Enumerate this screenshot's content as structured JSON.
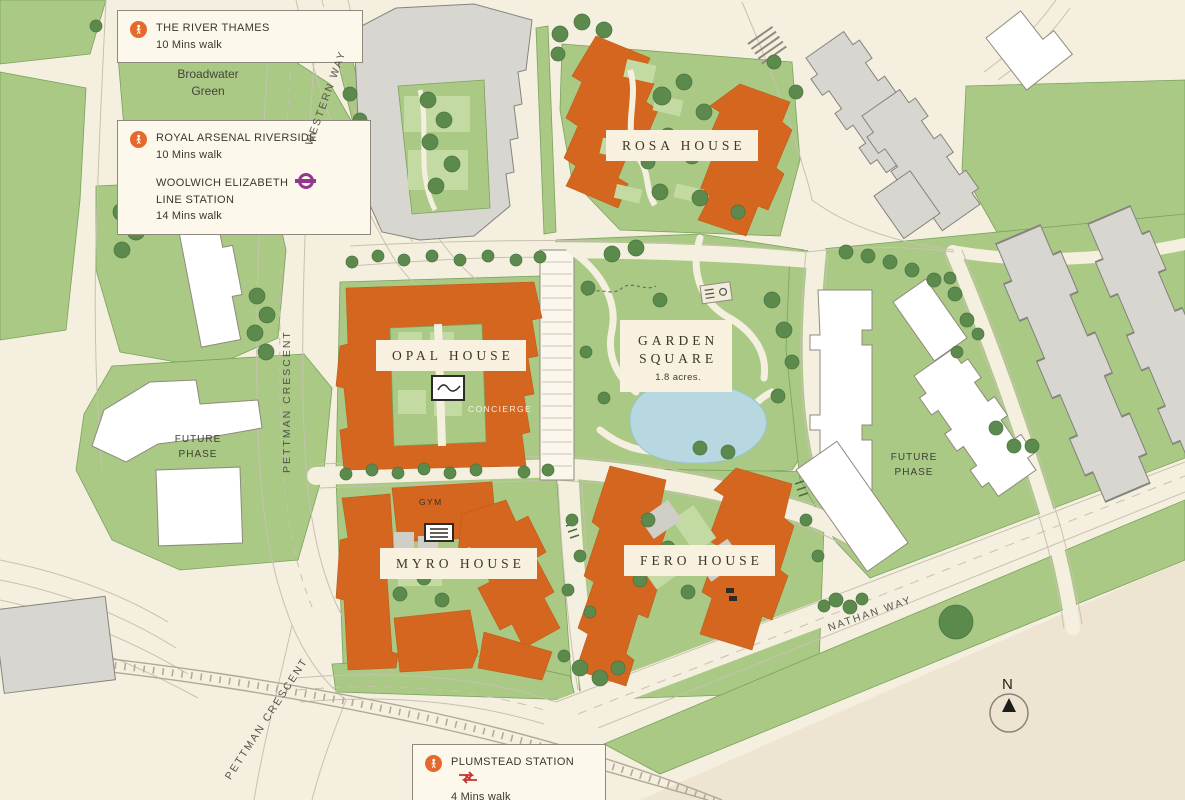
{
  "legend": {
    "thames": {
      "title": "THE RIVER THAMES",
      "walk": "10 Mins walk"
    },
    "royal_arsenal": {
      "title": "ROYAL ARSENAL RIVERSIDE",
      "walk": "10 Mins walk"
    },
    "woolwich": {
      "line1": "WOOLWICH ELIZABETH",
      "line2": "LINE STATION",
      "walk": "14 Mins walk"
    },
    "plumstead": {
      "title": "PLUMSTEAD STATION",
      "walk": "4 Mins walk"
    }
  },
  "buildings": {
    "rosa": "ROSA HOUSE",
    "opal": "OPAL HOUSE",
    "myro": "MYRO HOUSE",
    "fero": "FERO HOUSE"
  },
  "facilities": {
    "concierge": "CONCIERGE",
    "gym": "GYM"
  },
  "garden_square": {
    "line1": "GARDEN",
    "line2": "SQUARE",
    "area": "1.8 acres."
  },
  "places": {
    "broadwater_line1": "Broadwater",
    "broadwater_line2": "Green",
    "future_line1": "FUTURE",
    "future_line2": "PHASE"
  },
  "roads": {
    "western_way": "WESTERN WAY",
    "pettman_crescent": "PETTMAN CRESCENT",
    "nathan_way": "NATHAN WAY"
  },
  "compass": {
    "n": "N"
  },
  "colors": {
    "new_building_orange": "#D4661F",
    "green_space": "#A9C985",
    "tree_green": "#5B8A4C",
    "pond_blue": "#B7D8E1",
    "elizabeth_line_purple": "#93388F",
    "national_rail_red": "#C8322E",
    "walk_icon_orange": "#E4692D",
    "background_cream": "#F5EFDF"
  }
}
